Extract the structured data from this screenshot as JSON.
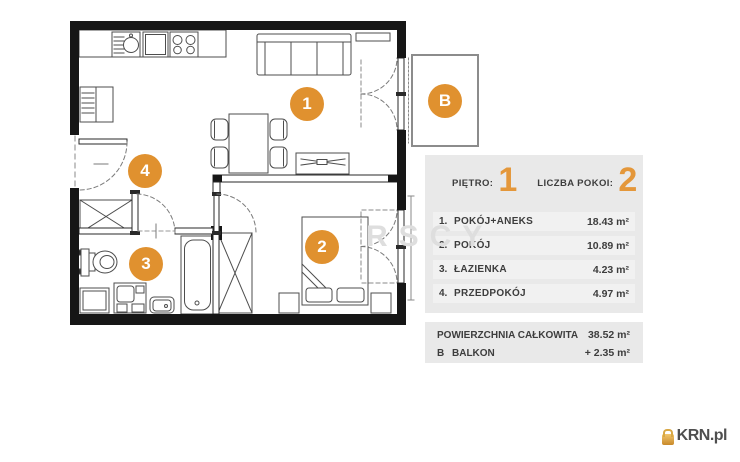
{
  "floorplan": {
    "markers": {
      "room1": "1",
      "room2": "2",
      "room3": "3",
      "room4": "4",
      "balcony": "B"
    }
  },
  "panel": {
    "floor_label": "PIĘTRO:",
    "floor_value": "1",
    "rooms_count_label": "LICZBA POKOI:",
    "rooms_count_value": "2",
    "rooms": [
      {
        "no": "1.",
        "name": "POKÓJ+ANEKS",
        "area": "18.43 m²"
      },
      {
        "no": "2.",
        "name": "POKÓJ",
        "area": "10.89 m²"
      },
      {
        "no": "3.",
        "name": "ŁAZIENKA",
        "area": "4.23 m²"
      },
      {
        "no": "4.",
        "name": "PRZEDPOKÓJ",
        "area": "4.97 m²"
      }
    ],
    "total_label": "POWIERZCHNIA CAŁKOWITA",
    "total_area": "38.52 m²",
    "balcony_no": "B",
    "balcony_label": "BALKON",
    "balcony_area": "+ 2.35 m²"
  },
  "watermark": "RSCY",
  "logo": {
    "brand": "KRN.pl"
  },
  "colors": {
    "accent_orange": "#E0912F",
    "digit_orange": "#E4973A",
    "panel_gray": "#E9E9E9",
    "row_gray": "#F1F1F1",
    "wall_black": "#161616",
    "line_gray": "#4D4D4D",
    "logo_gold": "#D8A845",
    "logo_text": "#4F4F4F"
  }
}
